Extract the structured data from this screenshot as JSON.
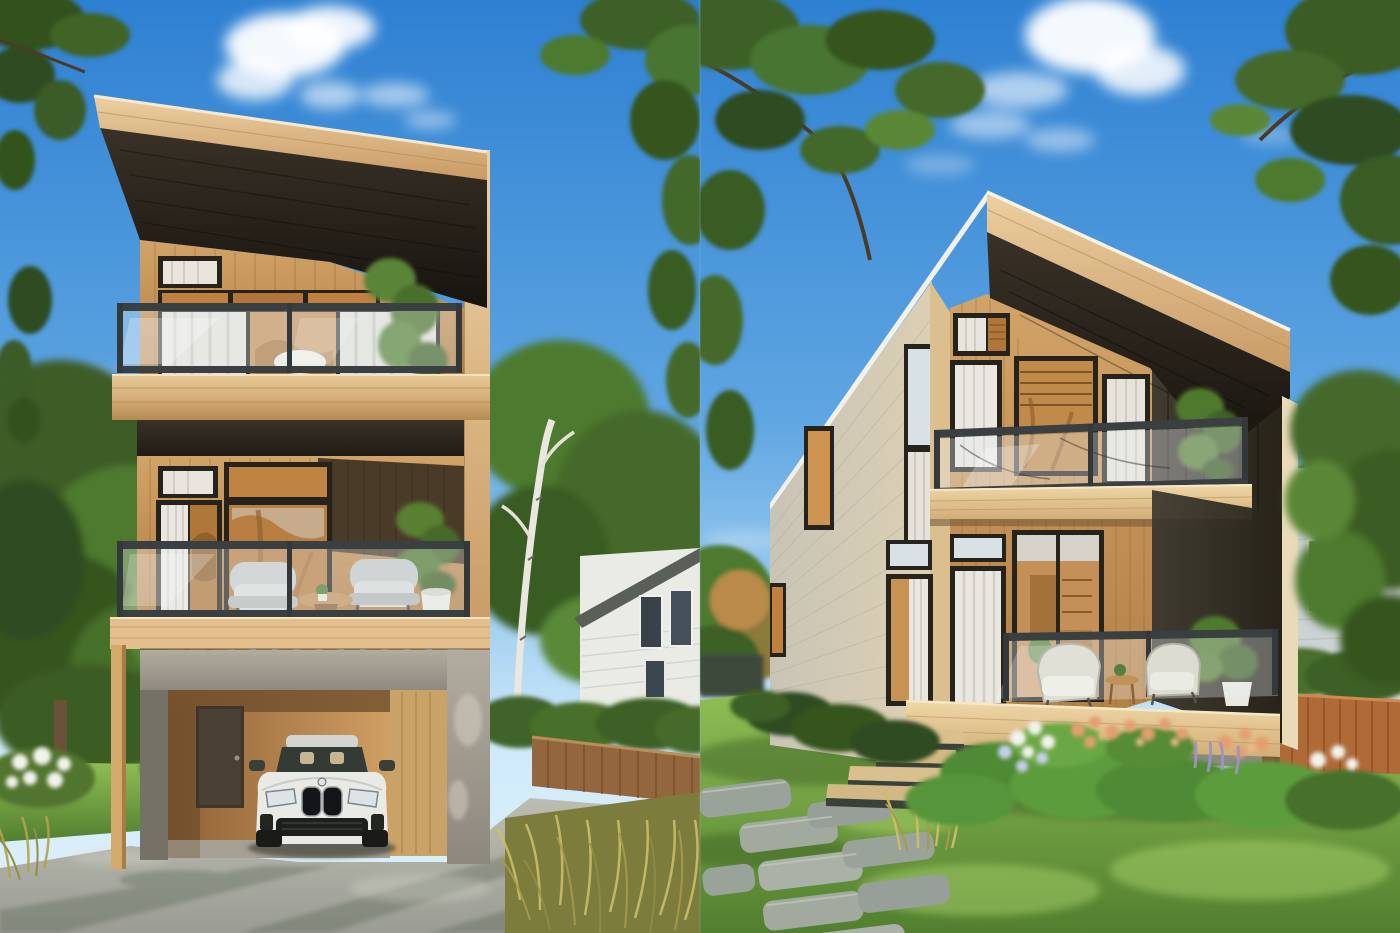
{
  "scene": {
    "type": "architectural-exterior-rendering-diptych",
    "description": "Two daylight renderings of a modern tall infill house with cedar siding, spliced side by side with a hard seam at the horizontal center",
    "panels": [
      {
        "id": "left",
        "view": "front elevation",
        "elements": [
          "slanted shed roof with light wood fascia",
          "dark roof soffit",
          "cedar-clad upper floor with clerestory windows and glass-railing balcony",
          "middle floor balcony with two grey armchairs, round wood table and potted plants",
          "exposed rafter tails",
          "concrete carport with white sedan parked inside",
          "dark entry door inside carport",
          "slender wood support post",
          "concrete driveway with tree shadows",
          "lawn and large tree on the left",
          "white neighbour house, birch trunk, brown fence, white flower bushes and ornamental grasses on the right"
        ]
      },
      {
        "id": "right",
        "view": "three-quarter front",
        "elements": [
          "angled shed roof with white edge and wood fascia",
          "grey-beige clapboard side wall with lit windows",
          "cedar front facade with curtain and wood-blind windows",
          "recessed upper balcony with glass railing and plant",
          "charred-black accent wall on the right",
          "ground-floor porch with glass railing, two wicker chairs, side table and white planter",
          "sunlit wood deck band and wood steps",
          "garden bed with peach roses, white-blue hydrangeas and lavender",
          "stone paver path through green lawn",
          "orange wood fence, hedge and blue-grey neighbour house with teal roof",
          "overhanging tree canopies"
        ]
      }
    ],
    "lighting": "bright summer afternoon, blue sky with scattered white clouds",
    "palette": {
      "sky_top": "#2e80d2",
      "sky_mid": "#5fa6e2",
      "sky_low": "#cfeafa",
      "sky_haze": "#e2f1fb",
      "cloud": "#ffffff",
      "foliage_dark": "#2e4b20",
      "foliage_mid": "#4d7a2d",
      "foliage_light": "#6f9e3f",
      "foliage_sun": "#9cc45c",
      "branch": "#4a3b26",
      "wood_fascia": "#c99a64",
      "wood_fascia_light": "#ecd0a2",
      "wood_facade": "#b07c42",
      "wood_facade_light": "#d2a368",
      "plank_line": "#8f5f2c",
      "soffit": "#17130e",
      "soffit_light": "#3a3228",
      "band_wood": "#d9b887",
      "railing_frame": "#3a3f42",
      "window_frame": "#26231d",
      "glass_amber": "#c08040",
      "glass_sky": "#d9e6ec",
      "curtain": "#edebe4",
      "concrete": "#8d887d",
      "concrete_light": "#b2aca0",
      "plywood": "#cf9f63",
      "plywood_dark": "#8f6134",
      "door_brown": "#3f352b",
      "car_white": "#e9eae5",
      "car_glass": "#343a34",
      "car_grille": "#141518",
      "drive": "#9b9c94",
      "drive_light": "#bcbdb2",
      "drive_shadow": "#5e6a58",
      "grass_light": "#8fbe55",
      "grass_dark": "#527f2f",
      "orn_grass": "#b3a34e",
      "orn_grass_light": "#d2c46c",
      "fence_left": "#93663e",
      "fence_right": "#b06a38",
      "house_white": "#eceee8",
      "gray_wall": "#c6c3b6",
      "gray_wall_warm": "#dccfb4",
      "dark_wall": "#262319",
      "dark_wall_light": "#413c32",
      "birch": "#e9e7df",
      "stone": "#a2a99f",
      "stone_light": "#c2c8bc",
      "flower_white": "#f2f3ec",
      "flower_peach": "#e59e6e",
      "flower_blue": "#c3d0e8",
      "flower_lavender": "#9d94c2",
      "teal_roof": "#53796f",
      "bluegray_house": "#ccd3d4",
      "deck_wood": "#d2ae78",
      "deck_wood_light": "#f0d8a8",
      "trim_cream": "#e9dbb8"
    }
  }
}
